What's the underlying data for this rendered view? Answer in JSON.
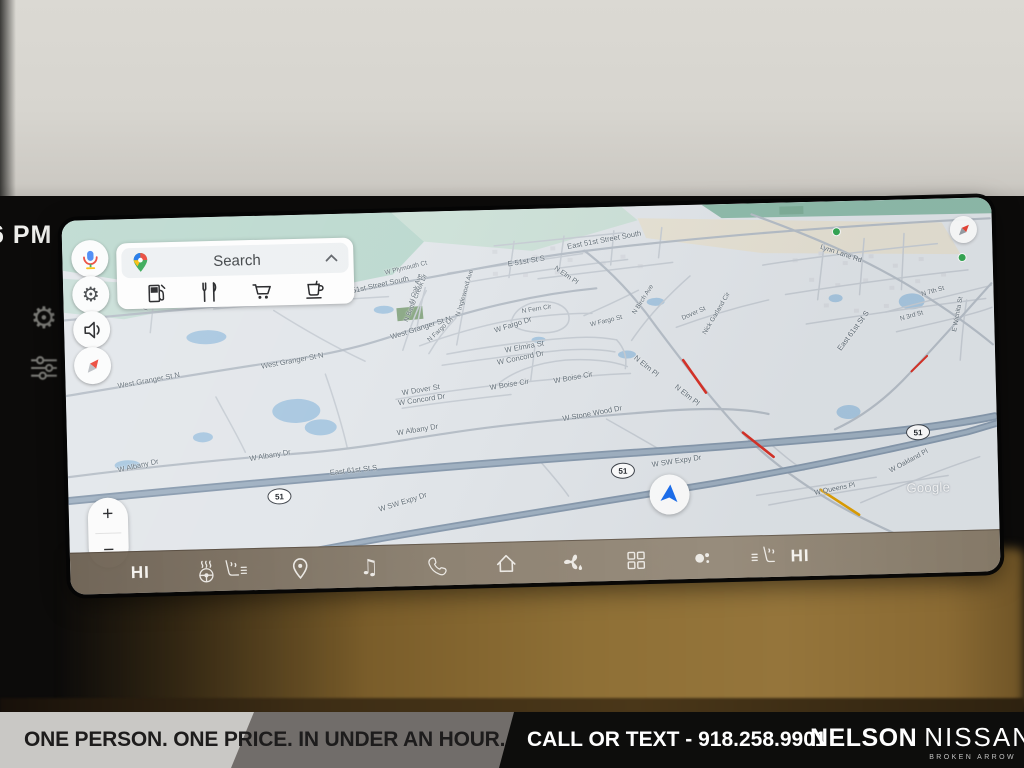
{
  "window": {
    "clock": "6 PM"
  },
  "bezel": {
    "buttons": [
      "settings",
      "equalizer"
    ]
  },
  "screen": {
    "float_buttons": [
      "voice-assistant",
      "settings",
      "volume",
      "compass"
    ],
    "search": {
      "placeholder": "Search",
      "categories": [
        "gas-stations",
        "restaurants",
        "groceries",
        "coffee"
      ]
    },
    "zoom_controls": {
      "in": "+",
      "out": "−"
    },
    "bottom_bar": {
      "driver_heat": "HI",
      "passenger_heat": "HI",
      "music_icon": "♫"
    },
    "map": {
      "watermark": "Google",
      "traffic_colors": {
        "red": "#d93025",
        "orange": "#e09f00"
      },
      "shields": [
        {
          "label": "51",
          "x": 199,
          "y": 273
        },
        {
          "label": "51",
          "x": 543,
          "y": 256
        },
        {
          "label": "51",
          "x": 839,
          "y": 225
        }
      ],
      "labels": [
        {
          "t": "E 51st St S",
          "x": 445,
          "y": 50,
          "r": -8
        },
        {
          "t": "East 51st Street South",
          "x": 505,
          "y": 34,
          "r": -9
        },
        {
          "t": "East 51st Street South",
          "x": 272,
          "y": 76,
          "r": -11
        },
        {
          "t": "W Plymouth Ct",
          "x": 322,
          "y": 57,
          "r": -12,
          "s": 6.5
        },
        {
          "t": "W Lincoln St N",
          "x": 222,
          "y": 80,
          "r": -5
        },
        {
          "t": "N Oak Ave",
          "x": 348,
          "y": 88,
          "r": -72,
          "s": 6.5
        },
        {
          "t": "N Club Ave",
          "x": 82,
          "y": 88,
          "r": -70,
          "s": 6.5
        },
        {
          "t": "N Battle Creek Dr",
          "x": 342,
          "y": 106,
          "r": -66,
          "s": 6.5
        },
        {
          "t": "N Inglewood Ave",
          "x": 394,
          "y": 102,
          "r": -72,
          "s": 6.5
        },
        {
          "t": "West Granger St N",
          "x": 52,
          "y": 162,
          "r": -9
        },
        {
          "t": "West Granger St N",
          "x": 196,
          "y": 146,
          "r": -9
        },
        {
          "t": "West Granger St N",
          "x": 326,
          "y": 120,
          "r": -16
        },
        {
          "t": "N Fargo Ln",
          "x": 364,
          "y": 126,
          "r": -42,
          "s": 6.5
        },
        {
          "t": "W Fargo Dr",
          "x": 430,
          "y": 116,
          "r": -16
        },
        {
          "t": "N Fern Cir",
          "x": 458,
          "y": 99,
          "r": -8,
          "s": 6.5
        },
        {
          "t": "W Elmira St",
          "x": 440,
          "y": 136,
          "r": -9
        },
        {
          "t": "W Concord Dr",
          "x": 432,
          "y": 148,
          "r": -10
        },
        {
          "t": "W Dover St",
          "x": 336,
          "y": 176,
          "r": -8
        },
        {
          "t": "W Concord Dr",
          "x": 332,
          "y": 186,
          "r": -7
        },
        {
          "t": "W Boise Cir",
          "x": 424,
          "y": 173,
          "r": -8
        },
        {
          "t": "W Boise Cir",
          "x": 488,
          "y": 168,
          "r": -9
        },
        {
          "t": "W Albany Dr",
          "x": 50,
          "y": 246,
          "r": -11
        },
        {
          "t": "W Albany Dr",
          "x": 182,
          "y": 238,
          "r": -8
        },
        {
          "t": "W Albany Dr",
          "x": 330,
          "y": 216,
          "r": -8
        },
        {
          "t": "W Stone Wood Dr",
          "x": 496,
          "y": 206,
          "r": -9
        },
        {
          "t": "East 61st St S",
          "x": 262,
          "y": 254,
          "r": -5
        },
        {
          "t": "W SW Expy Dr",
          "x": 310,
          "y": 292,
          "r": -16
        },
        {
          "t": "W SW Expy Dr",
          "x": 584,
          "y": 254,
          "r": -7
        },
        {
          "t": "N Elm Pl",
          "x": 492,
          "y": 56,
          "r": 36,
          "s": 7
        },
        {
          "t": "N Elm Pl",
          "x": 570,
          "y": 146,
          "r": 40
        },
        {
          "t": "N Elm Pl",
          "x": 610,
          "y": 176,
          "r": 40
        },
        {
          "t": "Nick Garland Cir",
          "x": 640,
          "y": 126,
          "r": -58,
          "s": 6.5
        },
        {
          "t": "N Birch Ave",
          "x": 570,
          "y": 104,
          "r": -56,
          "s": 6.5
        },
        {
          "t": "Dover St",
          "x": 618,
          "y": 110,
          "r": -22,
          "s": 6.5
        },
        {
          "t": "W Fargo St",
          "x": 526,
          "y": 114,
          "r": -12,
          "s": 6.5
        },
        {
          "t": "Lynn Lane Rd",
          "x": 758,
          "y": 42,
          "r": 20,
          "s": 7
        },
        {
          "t": "East 61st St S",
          "x": 774,
          "y": 144,
          "r": -52
        },
        {
          "t": "N 7th St",
          "x": 858,
          "y": 92,
          "r": -14,
          "s": 6.5
        },
        {
          "t": "N 3rd St",
          "x": 836,
          "y": 116,
          "r": -14,
          "s": 6.5
        },
        {
          "t": "E Wichita St",
          "x": 890,
          "y": 130,
          "r": -78,
          "s": 6.5
        },
        {
          "t": "W Oakland Pl",
          "x": 822,
          "y": 268,
          "r": -27,
          "s": 7
        },
        {
          "t": "W Queens Pl",
          "x": 746,
          "y": 288,
          "r": -10,
          "s": 7
        }
      ]
    }
  },
  "banner": {
    "tagline": "ONE PERSON. ONE PRICE. IN UNDER AN HOUR.",
    "phone": "CALL OR TEXT - 918.258.9901",
    "dealer_line1": "NELSON",
    "dealer_line2": "NISSAN",
    "dealer_sub": "BROKEN ARROW",
    "colors": {
      "silver": "#c9c8c5",
      "gray": "#716d6a",
      "black": "#0d0d0c"
    }
  }
}
